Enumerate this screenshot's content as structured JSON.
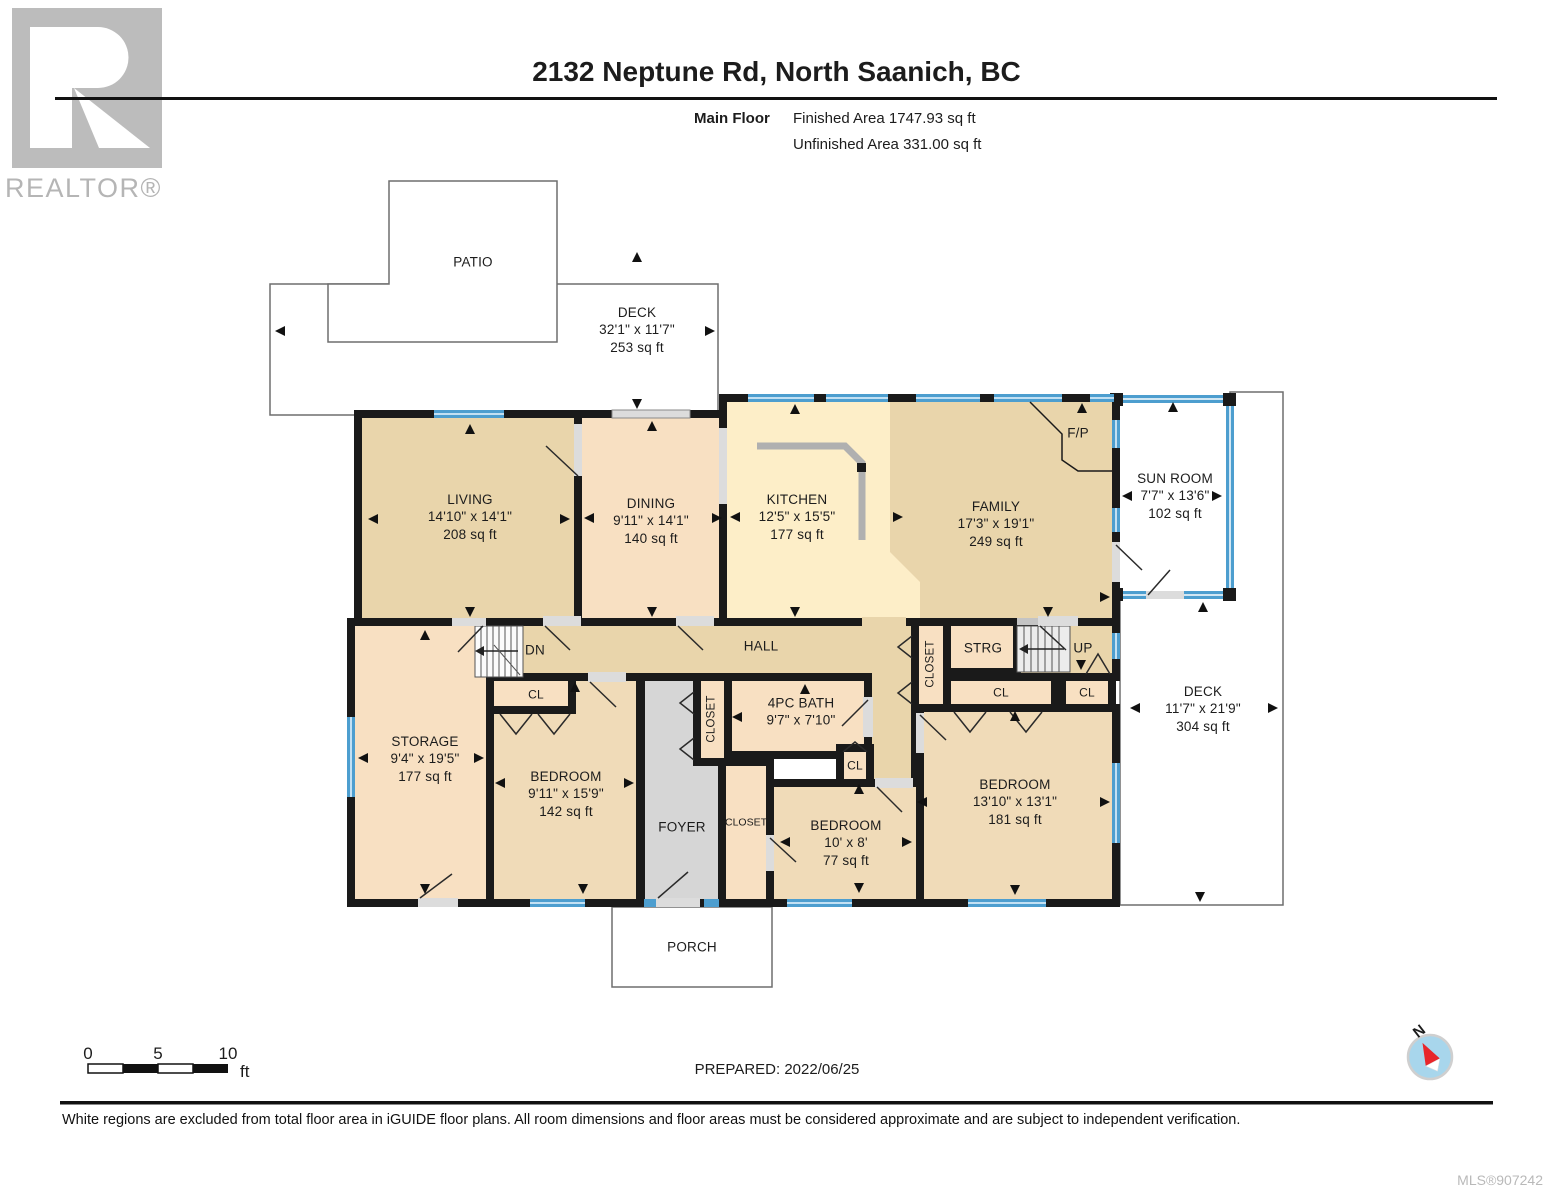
{
  "header": {
    "realtor_logo": "REALTOR®",
    "title": "2132 Neptune Rd, North Saanich, BC",
    "floor_label": "Main Floor",
    "finished_area": "Finished Area 1747.93 sq ft",
    "unfinished_area": "Unfinished Area 331.00 sq ft"
  },
  "plan": {
    "patio": {
      "name": "PATIO"
    },
    "deck_top": {
      "name": "DECK",
      "dims": "32'1\" x 11'7\"",
      "area": "253 sq ft"
    },
    "living": {
      "name": "LIVING",
      "dims": "14'10\" x 14'1\"",
      "area": "208 sq ft"
    },
    "dining": {
      "name": "DINING",
      "dims": "9'11\" x 14'1\"",
      "area": "140 sq ft"
    },
    "kitchen": {
      "name": "KITCHEN",
      "dims": "12'5\" x 15'5\"",
      "area": "177 sq ft"
    },
    "family": {
      "name": "FAMILY",
      "dims": "17'3\" x 19'1\"",
      "area": "249 sq ft"
    },
    "sunroom": {
      "name": "SUN ROOM",
      "dims": "7'7\" x 13'6\"",
      "area": "102 sq ft"
    },
    "fireplace": "F/P",
    "hall": "HALL",
    "stairs_down": "DN",
    "stairs_up": "UP",
    "storage_small": "STRG",
    "closet": "CLOSET",
    "closet_small": "CL",
    "storage": {
      "name": "STORAGE",
      "dims": "9'4\" x 19'5\"",
      "area": "177 sq ft"
    },
    "bedroom1": {
      "name": "BEDROOM",
      "dims": "9'11\" x 15'9\"",
      "area": "142 sq ft"
    },
    "bath": {
      "name": "4PC BATH",
      "dims": "9'7\" x 7'10\""
    },
    "bedroom2": {
      "name": "BEDROOM",
      "dims": "10' x 8'",
      "area": "77 sq ft"
    },
    "bedroom3": {
      "name": "BEDROOM",
      "dims": "13'10\" x 13'1\"",
      "area": "181 sq ft"
    },
    "deck_right": {
      "name": "DECK",
      "dims": "11'7\" x 21'9\"",
      "area": "304 sq ft"
    },
    "foyer": "FOYER",
    "porch": "PORCH"
  },
  "scale_bar": {
    "tick_0": "0",
    "tick_5": "5",
    "tick_10": "10",
    "unit": "ft"
  },
  "compass": {
    "north": "N"
  },
  "footer": {
    "prepared": "PREPARED: 2022/06/25",
    "disclaimer": "White regions are excluded from total floor area in iGUIDE floor plans. All room dimensions and floor areas must be considered approximate and are subject to independent verification.",
    "mls": "MLS®907242"
  },
  "colors": {
    "wall_black": "#1a1a1a",
    "window_blue": "#4d9ecf",
    "floor_tan": "#e9d5ab",
    "floor_peach": "#f8e0c2",
    "floor_kitchen": "#fdeec8",
    "floor_bedroom": "#f0dbb8",
    "floor_gray": "#d6d6d6",
    "compass_red": "#e8262a",
    "compass_blue": "#a8d6ec",
    "logo_gray": "#bcbcbc"
  }
}
